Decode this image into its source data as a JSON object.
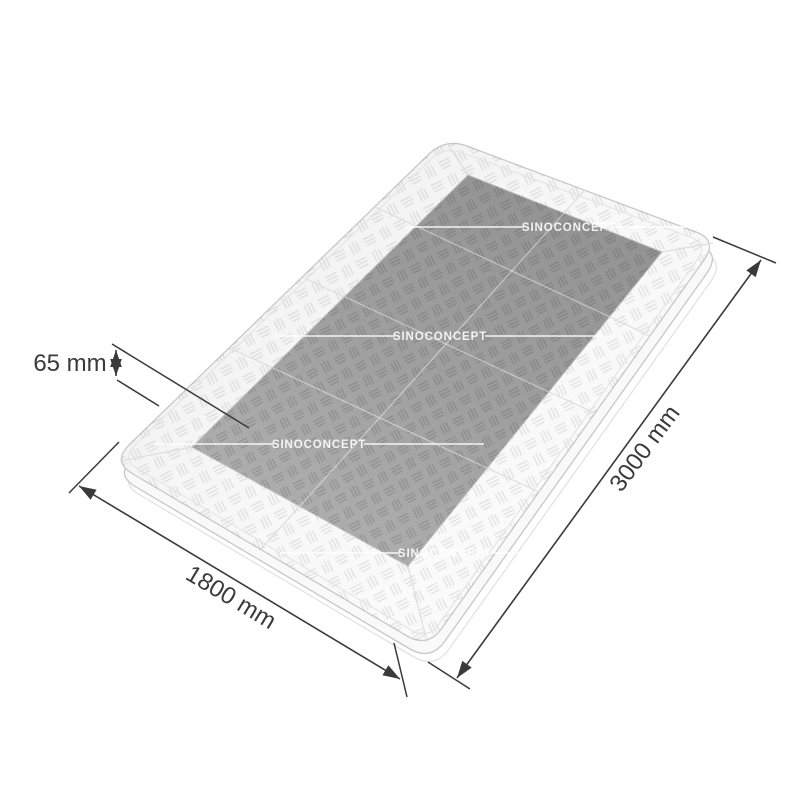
{
  "diagram": {
    "description": "speed-table-dimension-diagram",
    "watermark": {
      "text": "SINOCONCEPT"
    },
    "dimensions": {
      "height": {
        "label": "65 mm"
      },
      "width": {
        "label": "1800 mm"
      },
      "length": {
        "label": "3000 mm"
      }
    },
    "colors": {
      "background": "#ffffff",
      "plate_surface": "#f7f7f7",
      "dark_panel": "#a0a0a0",
      "dimension_line": "#3a3a3a",
      "watermark": "#ffffff"
    }
  }
}
